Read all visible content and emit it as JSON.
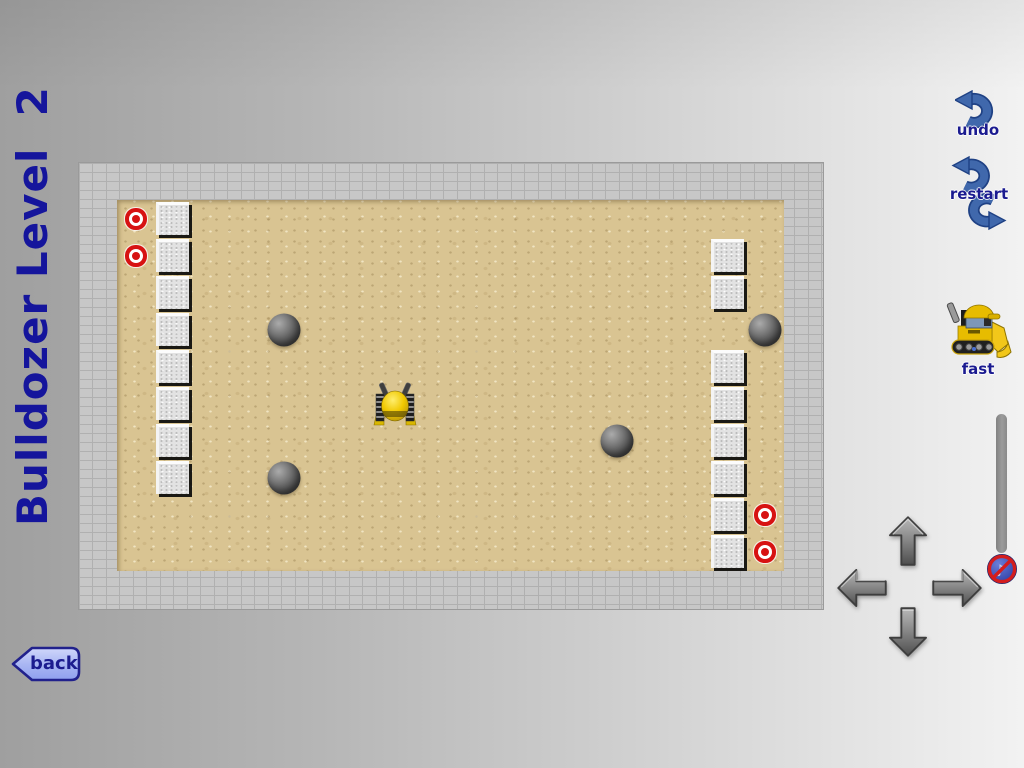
{
  "title": {
    "text": "Bulldozer Level  2"
  },
  "buttons": {
    "undo": {
      "label": "undo"
    },
    "restart": {
      "label": "restart"
    },
    "fast": {
      "label": "fast"
    },
    "back": {
      "label": "back"
    }
  },
  "icons": {
    "undo": "undo-curved-arrow-icon",
    "restart": "circular-arrows-icon",
    "fast": "bulldozer-side-icon",
    "slider_knob": "sound-off-icon",
    "dpad": [
      "arrow-up-icon",
      "arrow-left-icon",
      "arrow-right-icon",
      "arrow-down-icon"
    ],
    "back": "left-pointing-tab-icon"
  },
  "slider": {
    "orientation": "vertical",
    "knob_position": "bottom"
  },
  "board": {
    "cols": 18,
    "rows": 10,
    "wall_style": "gray-brick",
    "floor_style": "sand",
    "blocks": [
      [
        1,
        0
      ],
      [
        1,
        1
      ],
      [
        1,
        2
      ],
      [
        1,
        3
      ],
      [
        1,
        4
      ],
      [
        1,
        5
      ],
      [
        1,
        6
      ],
      [
        1,
        7
      ],
      [
        16,
        1
      ],
      [
        16,
        2
      ],
      [
        16,
        4
      ],
      [
        16,
        5
      ],
      [
        16,
        6
      ],
      [
        16,
        7
      ],
      [
        16,
        8
      ],
      [
        16,
        9
      ]
    ],
    "targets": [
      [
        0,
        0
      ],
      [
        0,
        1
      ],
      [
        17,
        8
      ],
      [
        17,
        9
      ]
    ],
    "balls": [
      [
        4,
        3
      ],
      [
        4,
        7
      ],
      [
        13,
        6
      ],
      [
        17,
        3
      ]
    ],
    "bulldozer": {
      "col": 7,
      "row": 5,
      "facing": "up"
    }
  },
  "colors": {
    "title_navy": "#15159c",
    "label_navy": "#1b1b90",
    "button_blue": "#4068ac",
    "button_blue_dark": "#1f4184",
    "back_fill": "#aab7f3",
    "sand": "#d9c492",
    "wall_gray": "#c7c7c7",
    "target_red": "#d71212",
    "dozer_yellow": "#e7bc00"
  }
}
